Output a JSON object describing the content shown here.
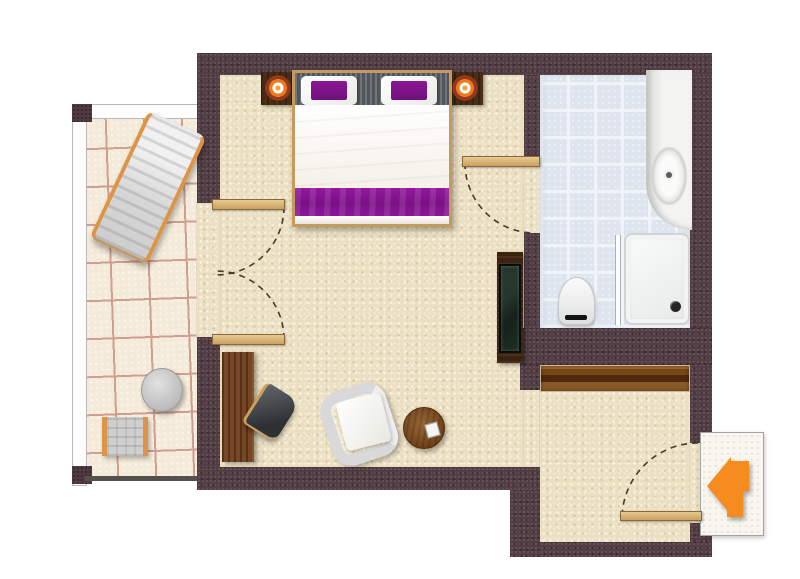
{
  "figure": {
    "type": "floor-plan",
    "subject": "Hotel room floor plan: bedroom with double bed, bathroom, entry hallway with wardrobe, and furnished balcony; orange arrow marks the entrance"
  },
  "palette": {
    "wall": "#523c44",
    "wall_edge": "#cdc1b0",
    "carpet": "#ebdfc1",
    "balcony_tile": "#f4ead9",
    "balcony_grout": "#cf9f8e",
    "bath_tile": "#dee5ef",
    "bath_grout": "#f0f4f9",
    "purple": "#8b1694",
    "purple_deep": "#70107c",
    "headboard": "#5a6067",
    "desk_wood": "#6e3c1a",
    "cabinet_wood": "#3c2310",
    "door_wood": "#d9b273",
    "orange": "#f68b1f",
    "lounger_frame": "#dd9447",
    "arc": "#4b3a27",
    "entry_bg": "#f8f6ef"
  },
  "rooms": {
    "bedroom": "Bedroom with sitting area",
    "bathroom": "Bathroom",
    "hallway": "Entry hallway",
    "balcony": "Balcony"
  },
  "items": {
    "bed": "Double bed with white duvet, purple runner and two purple cushions",
    "nightstand_left": "Left nightstand with orange lamp",
    "nightstand_right": "Right nightstand with orange lamp",
    "tv": "TV cabinet with flat screen",
    "desk": "Wooden desk",
    "desk_chair": "Desk chair",
    "armchair": "White armchair",
    "side_table": "Round wooden side table",
    "wardrobe": "Built-in wardrobe",
    "vanity": "Vanity counter with oval sink",
    "shower": "Shower with glass panel",
    "toilet": "Toilet",
    "lounger": "Sun lounger",
    "balcony_table": "Round balcony table",
    "balcony_chair": "Balcony chair",
    "entry_arrow": "Entrance arrow pointing into the room",
    "balcony_door": "Double balcony door with swing arcs",
    "bathroom_door": "Bathroom door with swing arc",
    "entrance_door": "Entrance door with swing arc"
  }
}
